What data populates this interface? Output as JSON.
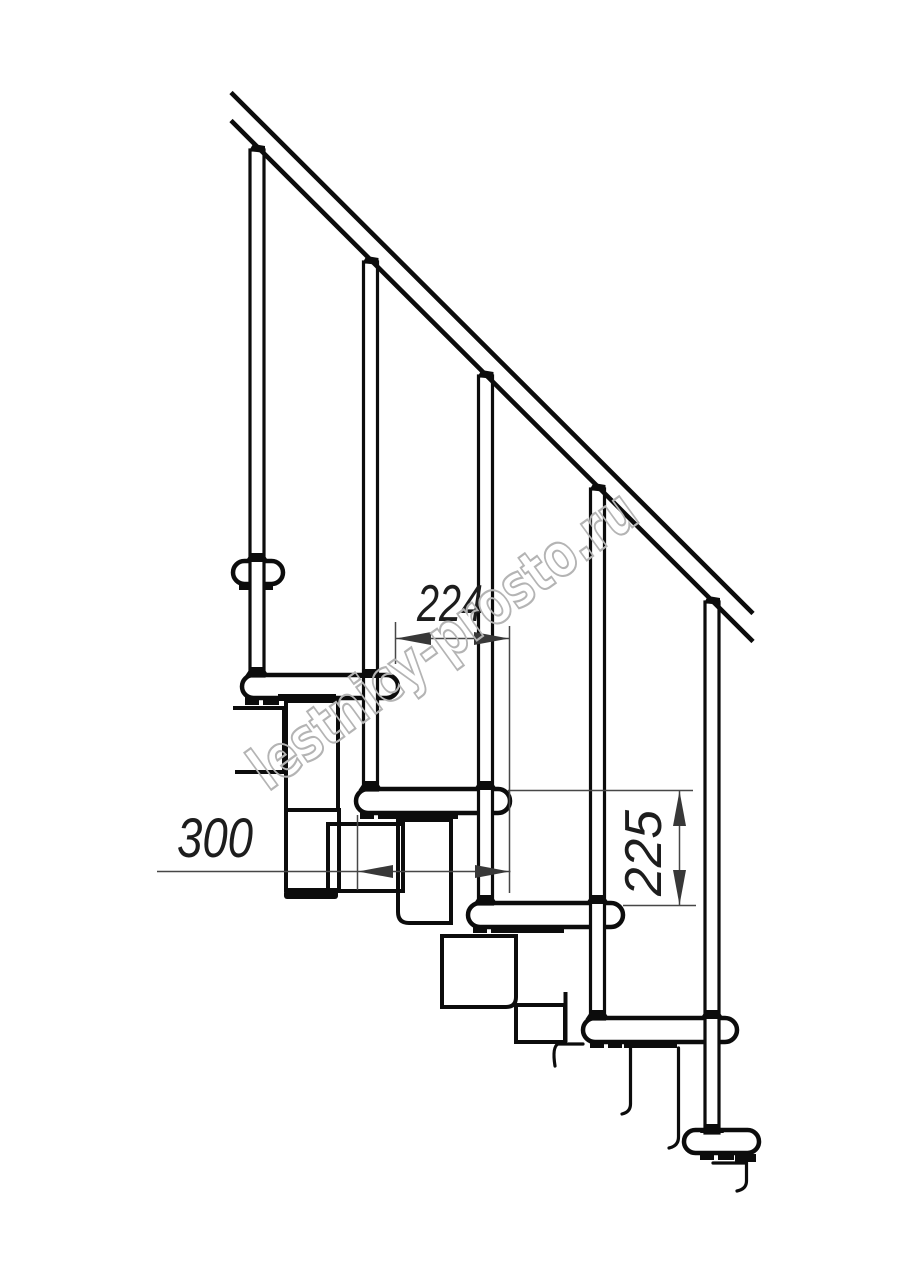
{
  "drawing": {
    "title": "modular staircase side-view technical drawing",
    "watermark": {
      "text": "lestnicy-prosto.ru",
      "color": "#b4b4b4"
    },
    "dimensions": {
      "run_label": "224",
      "depth_label": "300",
      "rise_label": "225"
    },
    "counts": {
      "treads": 6,
      "balusters": 5
    },
    "colors": {
      "background": "#ffffff",
      "main_line": "#0c0c0c",
      "dim_line": "#474747",
      "dim_text": "#1d1d1d",
      "watermark": "#b4b4b4"
    }
  }
}
